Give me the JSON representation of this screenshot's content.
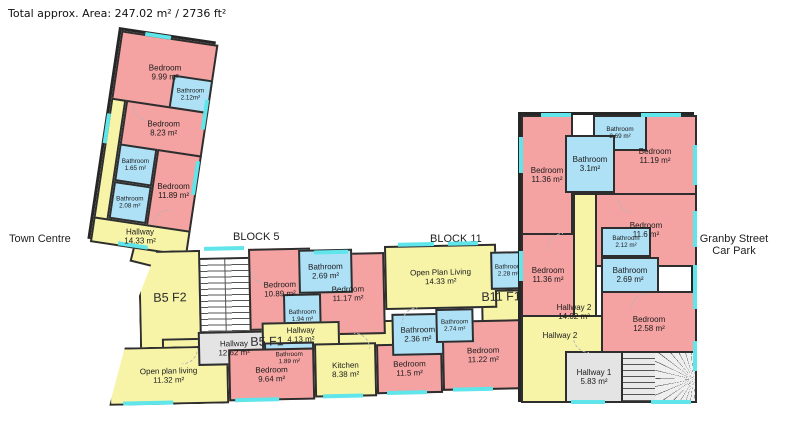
{
  "title": "Total approx. Area: 247.02 m² / 2736 ft²",
  "area_labels": {
    "town_centre": "Town Centre",
    "block_5": "BLOCK 5",
    "block_11": "BLOCK 11",
    "granby_street": "Granby Street",
    "car_park": "Car Park"
  },
  "floor_labels": {
    "b5_f2": "B5 F2",
    "b5_f1": "B5 F1",
    "b11_f1": "B11 F1"
  },
  "colors": {
    "bedroom_pink": "#f5a2a2",
    "bathroom_blue": "#aee0f6",
    "living_yellow": "#f7f4a8",
    "hall_gray": "#e4e4e4",
    "window_cyan": "#5fe5ea",
    "wall_black": "#2a2a2a"
  },
  "rooms": {
    "tl_bed_999": {
      "name": "Bedroom",
      "area": "9.99 m²"
    },
    "tl_bath_212": {
      "name": "Bathroom",
      "area": "2.12m²"
    },
    "tl_bed_823": {
      "name": "Bedroom",
      "area": "8.23 m²"
    },
    "tl_bath_165": {
      "name": "Bathroom",
      "area": "1.65 m²"
    },
    "tl_bath_208": {
      "name": "Bathroom",
      "area": "2.08 m²"
    },
    "tl_bed_1189": {
      "name": "Bedroom",
      "area": "11.89 m²"
    },
    "tl_hall_1433": {
      "name": "Hallway",
      "area": "14.33 m²"
    },
    "c_bed_1089": {
      "name": "Bedroom",
      "area": "10.89 m²"
    },
    "c_bath_269": {
      "name": "Bathroom",
      "area": "2.69 m²"
    },
    "c_bath_194": {
      "name": "Bathroom",
      "area": "1.94 m²"
    },
    "c_bed_1117": {
      "name": "Bedroom",
      "area": "11.17 m²"
    },
    "c_hall_1262": {
      "name": "Hallway",
      "area": "12.62 m²"
    },
    "c_hall_413": {
      "name": "Hallway",
      "area": "4.13 m²"
    },
    "c_bath_189": {
      "name": "Bathroom",
      "area": "1.89 m²"
    },
    "c_kitchen_838": {
      "name": "Kitchen",
      "area": "8.38 m²"
    },
    "c_bed_964": {
      "name": "Bedroom",
      "area": "9.64 m²"
    },
    "c_opl_1132": {
      "name": "Open plan living",
      "area": "11.32 m²"
    },
    "c_bed_115": {
      "name": "Bedroom",
      "area": "11.5 m²"
    },
    "c_opl_1433": {
      "name": "Open Plan Living",
      "area": "14.33 m²"
    },
    "c_bath_228": {
      "name": "Bathroom",
      "area": "2.28 m²"
    },
    "c_bath_236": {
      "name": "Bathroom",
      "area": "2.36 m²"
    },
    "c_bath_274": {
      "name": "Bathroom",
      "area": "2.74 m²"
    },
    "c_bed_1122": {
      "name": "Bedroom",
      "area": "11.22 m²"
    },
    "r_bed_1136_top": {
      "name": "Bedroom",
      "area": "11.36 m²"
    },
    "r_bath_31": {
      "name": "Bathroom",
      "area": "3.1m²"
    },
    "r_bath_269_top": {
      "name": "Bathroom",
      "area": "2.69 m²"
    },
    "r_bed_1119": {
      "name": "Bedroom",
      "area": "11.19 m²"
    },
    "r_bed_116": {
      "name": "Bedroom",
      "area": "11.6 m²"
    },
    "r_bed_1136_mid": {
      "name": "Bedroom",
      "area": "11.36 m²"
    },
    "r_bath_212": {
      "name": "Bathroom",
      "area": "2.12 m²"
    },
    "r_bath_269_mid": {
      "name": "Bathroom",
      "area": "2.69 m²"
    },
    "r_bed_1258": {
      "name": "Bedroom",
      "area": "12.58 m²"
    },
    "r_hall2_1402": {
      "name": "Hallway 2",
      "area": "14.02 m²"
    },
    "r_hall2": {
      "name": "Hallway 2",
      "area": ""
    },
    "r_hall1_583": {
      "name": "Hallway 1",
      "area": "5.83 m²"
    }
  }
}
